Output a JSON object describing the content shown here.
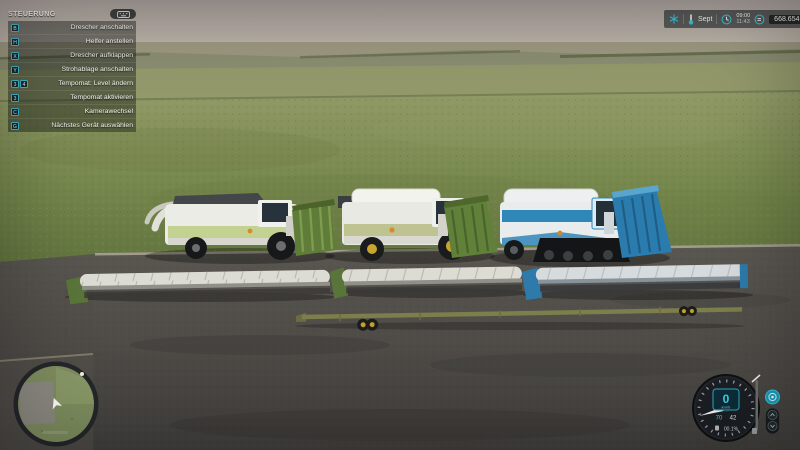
{
  "help_panel": {
    "title": "STEUERUNG",
    "items": [
      {
        "keys": [
          "B"
        ],
        "label": "Drescher anschalten"
      },
      {
        "keys": [
          "H"
        ],
        "label": "Helfer anstellen"
      },
      {
        "keys": [
          "X"
        ],
        "label": "Drescher aufklappen"
      },
      {
        "keys": [
          "Y"
        ],
        "label": "Strohablage anschalten"
      },
      {
        "keys": [
          "3",
          "4"
        ],
        "label": "Tempomat: Level ändern"
      },
      {
        "keys": [
          "3"
        ],
        "label": "Tempomat aktivieren"
      },
      {
        "keys": [
          "C"
        ],
        "label": "Kamerawechsel"
      },
      {
        "keys": [
          "G"
        ],
        "label": "Nächstes Gerät auswählen"
      }
    ]
  },
  "status_bar": {
    "month": "Sept",
    "time": "09:00",
    "time_secondary": "11:43",
    "money": "668.654.638",
    "icons": [
      "snowflake-icon",
      "thermometer-icon",
      "clock-icon",
      "currency-icon"
    ]
  },
  "speedometer": {
    "speed": "0",
    "unit": "km/h",
    "cruise_speed": "70",
    "secondary": "42",
    "fuel_level": "00.1%"
  },
  "scene": {
    "vehicles": [
      {
        "name": "combine-green-white"
      },
      {
        "name": "combine-white-olive"
      },
      {
        "name": "combine-blue-tracked"
      },
      {
        "name": "cutter-header-1"
      },
      {
        "name": "cutter-header-2"
      },
      {
        "name": "cutter-header-3"
      },
      {
        "name": "header-trailer"
      }
    ]
  },
  "colors": {
    "accent_teal": "#35c0d8",
    "panel_key_border": "#3fb6cc",
    "combine_green_accent": "#c3d291",
    "combine_olive_accent": "#bfc291",
    "combine_blue": "#2f86b8",
    "header_green": "#5a7539",
    "trailer_olive": "#7c7e4b",
    "rim_yellow": "#c9a52d",
    "grass": "#76864c",
    "asphalt": "#514e4a"
  }
}
